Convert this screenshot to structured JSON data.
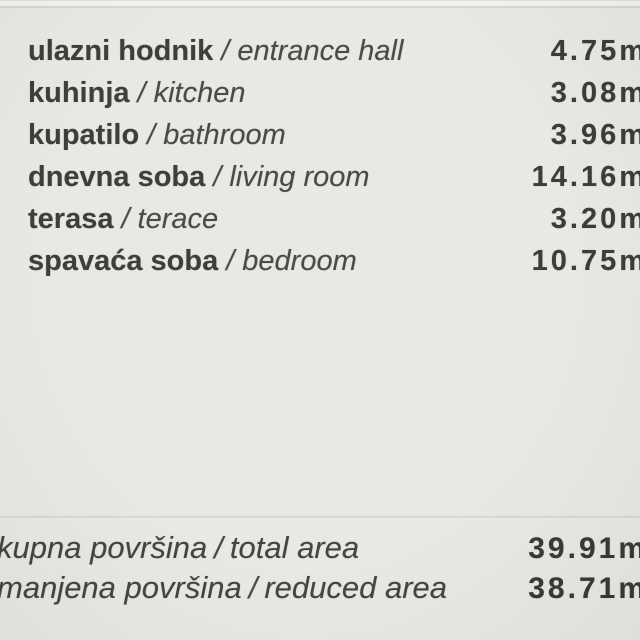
{
  "page": {
    "background_color": "#e9e8e5",
    "divider_color": "#d8d6d3",
    "bold_text_color": "#403e3c",
    "italic_text_color": "#4b4a48"
  },
  "separator": "/",
  "rooms": [
    {
      "name_sr": "ulazni hodnik",
      "name_en": "entrance hall",
      "area": "4.75m"
    },
    {
      "name_sr": "kuhinja",
      "name_en": "kitchen",
      "area": "3.08m"
    },
    {
      "name_sr": "kupatilo",
      "name_en": "bathroom",
      "area": "3.96m"
    },
    {
      "name_sr": "dnevna soba",
      "name_en": "living room",
      "area": "14.16m"
    },
    {
      "name_sr": "terasa",
      "name_en": "terace",
      "area": "3.20m"
    },
    {
      "name_sr": "spavaća soba",
      "name_en": "bedroom",
      "area": "10.75m"
    }
  ],
  "totals": [
    {
      "label_sr": "kupna površina",
      "label_en": "total area",
      "value": "39.91m"
    },
    {
      "label_sr": "manjena površina",
      "label_en": "reduced area",
      "value": "38.71m"
    }
  ]
}
